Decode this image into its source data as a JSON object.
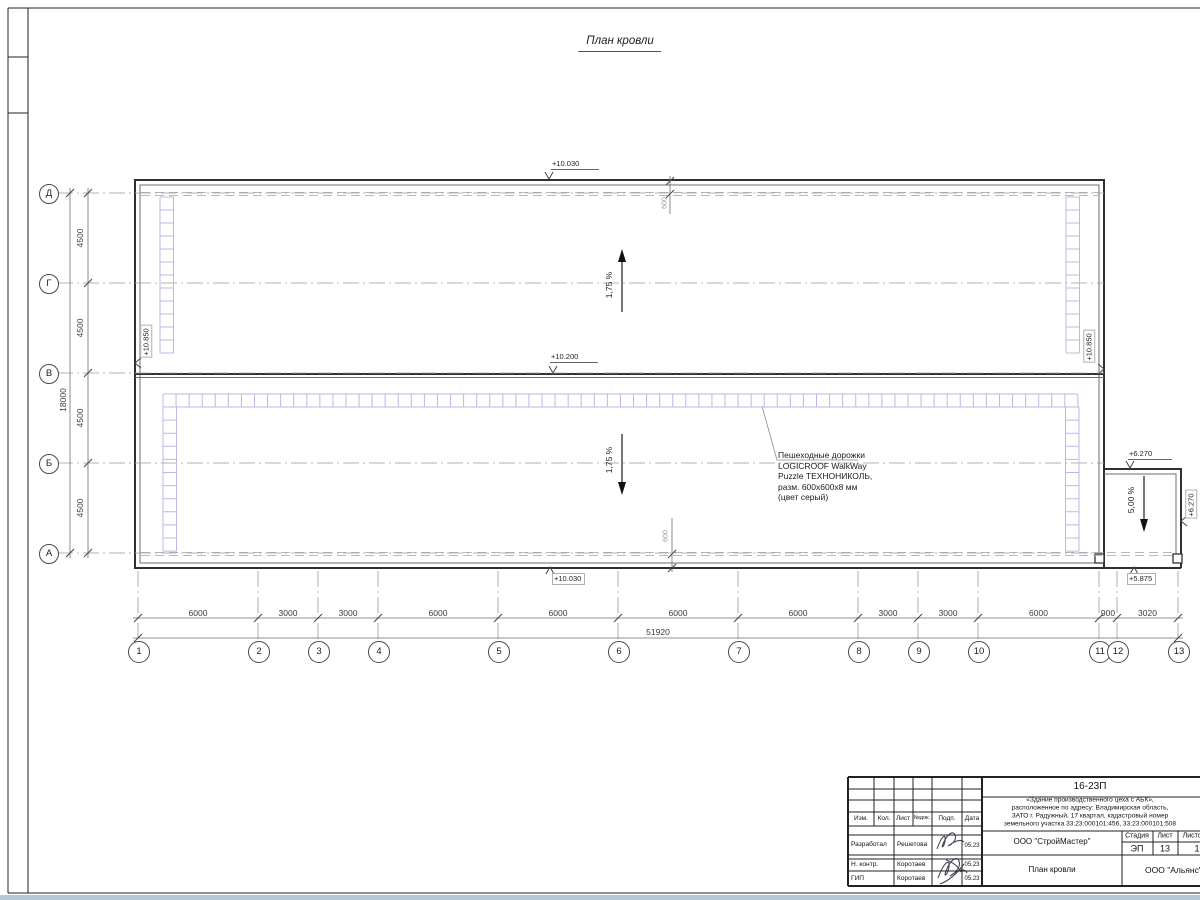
{
  "title": "План кровли",
  "grid": {
    "vertical_axes": [
      "1",
      "2",
      "3",
      "4",
      "5",
      "6",
      "7",
      "8",
      "9",
      "10",
      "11",
      "12",
      "13"
    ],
    "horizontal_axes": [
      "Д",
      "Г",
      "В",
      "Б",
      "А"
    ],
    "bottom_dims": [
      "6000",
      "3000",
      "3000",
      "6000",
      "6000",
      "6000",
      "6000",
      "3000",
      "3000",
      "6000",
      "900",
      "3020"
    ],
    "bottom_total": "51920",
    "left_dims": [
      "4500",
      "4500",
      "4500",
      "4500"
    ],
    "left_total": "18000",
    "gutter_offset_top": "600",
    "gutter_offset_bottom": "600"
  },
  "elevations": {
    "roof_high_top": "+10.030",
    "roof_valley": "+10.200",
    "roof_high_bottom": "+10.030",
    "parapet_left": "+10.850",
    "parapet_right": "+10.850",
    "canopy_top": "+6.270",
    "canopy_right": "+6.270",
    "canopy_edge": "+5.875"
  },
  "slopes": {
    "upper": "1,75 %",
    "lower": "1,75 %",
    "canopy": "5,00 %"
  },
  "annotation": {
    "line1": "Пешеходные дорожки",
    "line2": "LOGICROOF WalkWay",
    "line3": "Puzzle ТЕХНОНИКОЛЬ,",
    "line4": "разм. 600х600х8 мм",
    "line5": "(цвет серый)"
  },
  "title_block": {
    "doc_code": "16-23П",
    "desc1": "«Здание производственного цеха с АБК»,",
    "desc2": "расположенное по адресу: Владимирская область,",
    "desc3": "ЗАТО г. Радужный, 17 квартал, кадастровый номер",
    "desc4": "земельного участка 33:23:000101:456, 33:23:000101:508",
    "header": {
      "izm": "Изм.",
      "kol": "Кол.",
      "list": "Лист",
      "ndok": "№док.",
      "podp": "Подп.",
      "data": "Дата"
    },
    "rows": [
      {
        "role": "Разработал",
        "name": "Решетова",
        "date": "05.23"
      },
      {
        "role": "Н. контр.",
        "name": "Коротаев",
        "date": "05.23"
      },
      {
        "role": "ГИП",
        "name": "Коротаев",
        "date": "05.23"
      }
    ],
    "company": "ООО \"СтройМастер\"",
    "stage_label": "Стадия",
    "sheet_label": "Лист",
    "sheets_label": "Листов",
    "stage_value": "ЭП",
    "sheet_value": "13",
    "sheets_value": "1",
    "doc_title": "План кровли",
    "company2": "ООО \"Альянс\""
  }
}
